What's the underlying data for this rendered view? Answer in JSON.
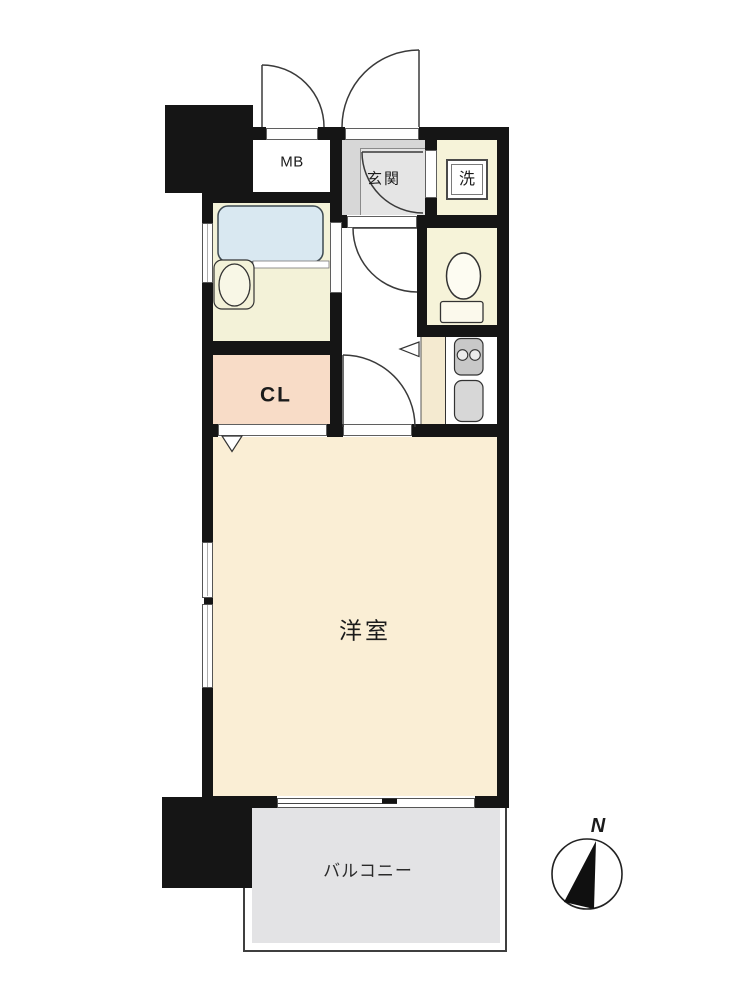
{
  "title": "apartment-floor-plan",
  "rooms": {
    "meter_box": {
      "label": "MB"
    },
    "entrance": {
      "label": "玄関"
    },
    "laundry": {
      "label": "洗"
    },
    "closet": {
      "label": "CL"
    },
    "western_room": {
      "label": "洋室"
    },
    "balcony": {
      "label": "バルコニー"
    }
  },
  "compass": {
    "north_label": "N"
  },
  "colors": {
    "wall": "#151515",
    "western_room_floor": "#faeed5",
    "service_room_floor": "#f6f3d9",
    "bathroom_floor": "#f3f2d8",
    "bathtub": "#d9e8f1",
    "closet_floor": "#f8dcc7",
    "kitchen_floor": "#f4ead0",
    "entrance_floor": "#d7d7d7",
    "entrance_step": "#e5e5e5",
    "balcony_floor": "#e3e3e5"
  }
}
